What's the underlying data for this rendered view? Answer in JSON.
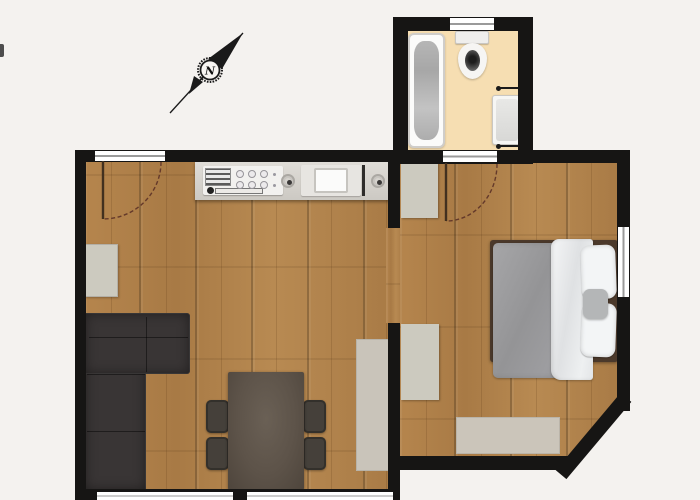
{
  "compass": {
    "label": "N"
  },
  "rooms": {
    "living_kitchen": {
      "fixtures": [
        "kitchen-counter",
        "cooktop",
        "kitchen-sink",
        "corner-sofa",
        "dining-table",
        "chairs-x4",
        "sideboard",
        "rug",
        "entrance-door",
        "windows-x2"
      ]
    },
    "bedroom": {
      "fixtures": [
        "double-bed",
        "duvet",
        "blanket",
        "pillows-x2",
        "cushion",
        "wardrobe-x2",
        "rug",
        "window"
      ]
    },
    "bathroom": {
      "fixtures": [
        "bathtub",
        "toilet",
        "washbasin",
        "towel-rails-x2",
        "door",
        "window"
      ]
    }
  },
  "colors": {
    "bg": "#f4f2ef",
    "wall": "#161514",
    "wood": "#b2824b",
    "bath_floor": "#f6deb2",
    "sofa": "#393535",
    "table": "#5d5349",
    "chair": "#45403a",
    "furniture_light": "#cccabf",
    "duvet": "#9d9da0",
    "door_arc": "#64392a"
  }
}
